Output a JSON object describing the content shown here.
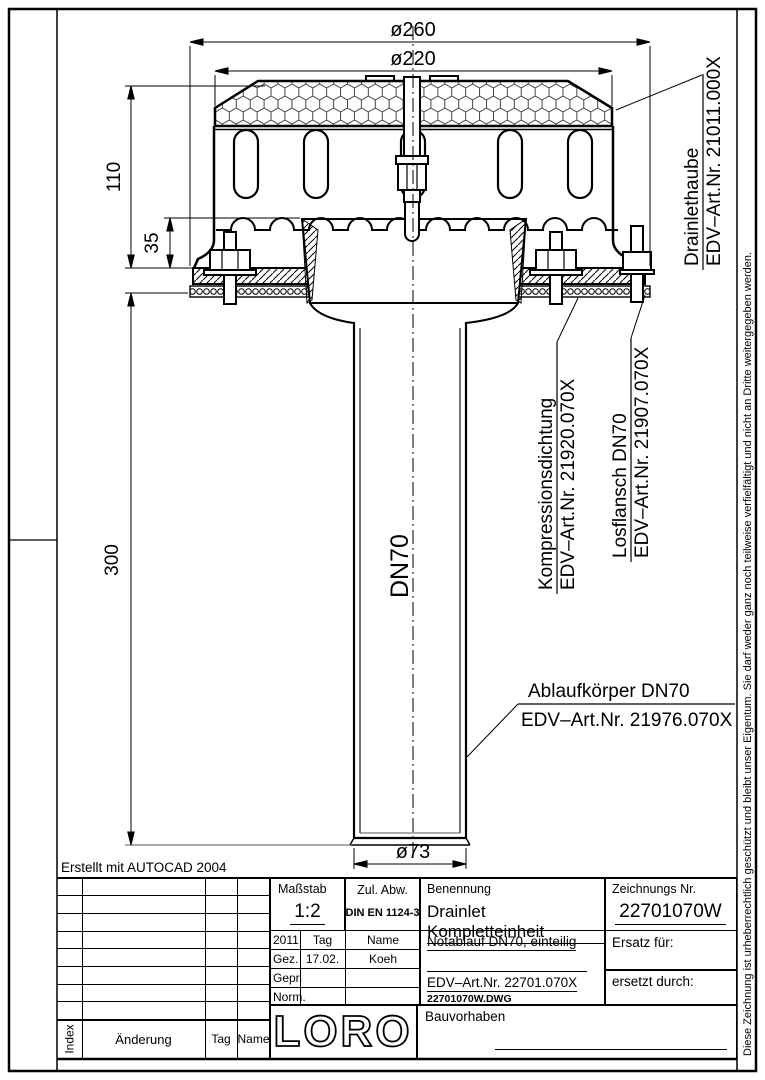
{
  "frame": {
    "note": "Erstellt mit AUTOCAD 2004",
    "copyright": "Diese Zeichnung ist urheberrechtlich geschützt und bleibt unser Eigentum. Sie darf weder ganz noch teilweise verfielfältigt und nicht an Dritte weitergegeben werden."
  },
  "drawing": {
    "dims": {
      "d260": "ø260",
      "d220": "ø220",
      "h110": "110",
      "h35": "35",
      "h300": "300",
      "d73": "ø73",
      "pipe": "DN70"
    },
    "labels": {
      "hood1": "Drainlethaube",
      "hood2": "EDV–Art.Nr. 21011.000X",
      "seal1": "Kompressionsdichtung",
      "seal2": "EDV–Art.Nr. 21920.070X",
      "flange1": "Losflansch DN70",
      "flange2": "EDV–Art.Nr. 21907.070X",
      "body1": "Ablaufkörper DN70",
      "body2": "EDV–Art.Nr. 21976.070X"
    }
  },
  "title_block": {
    "massstab_label": "Maßstab",
    "massstab_value": "1:2",
    "zul_label": "Zul. Abw.",
    "zul_value": "DIN EN 1124-3",
    "benennung_label": "Benennung",
    "benennung_value": "Drainlet Kompletteinheit",
    "zeichnr_label": "Zeichnungs Nr.",
    "zeichnr_value": "22701070W",
    "year": "2011",
    "tag_head": "Tag",
    "name_head": "Name",
    "gez": "Gez.",
    "gez_tag": "17.02.",
    "gez_name": "Koeh",
    "gepr": "Gepr.",
    "norm": "Norm.",
    "subtitle": "Notablauf DN70, einteilig",
    "artnr": "EDV–Art.Nr. 22701.070X",
    "file": "22701070W.DWG",
    "ersatz": "Ersatz für:",
    "ersetzt": "ersetzt durch:",
    "bauvorhaben": "Bauvorhaben",
    "logo": "LORO",
    "index_label": "Index",
    "aenderung_label": "Änderung",
    "rev_tag": "Tag",
    "rev_name": "Name"
  }
}
